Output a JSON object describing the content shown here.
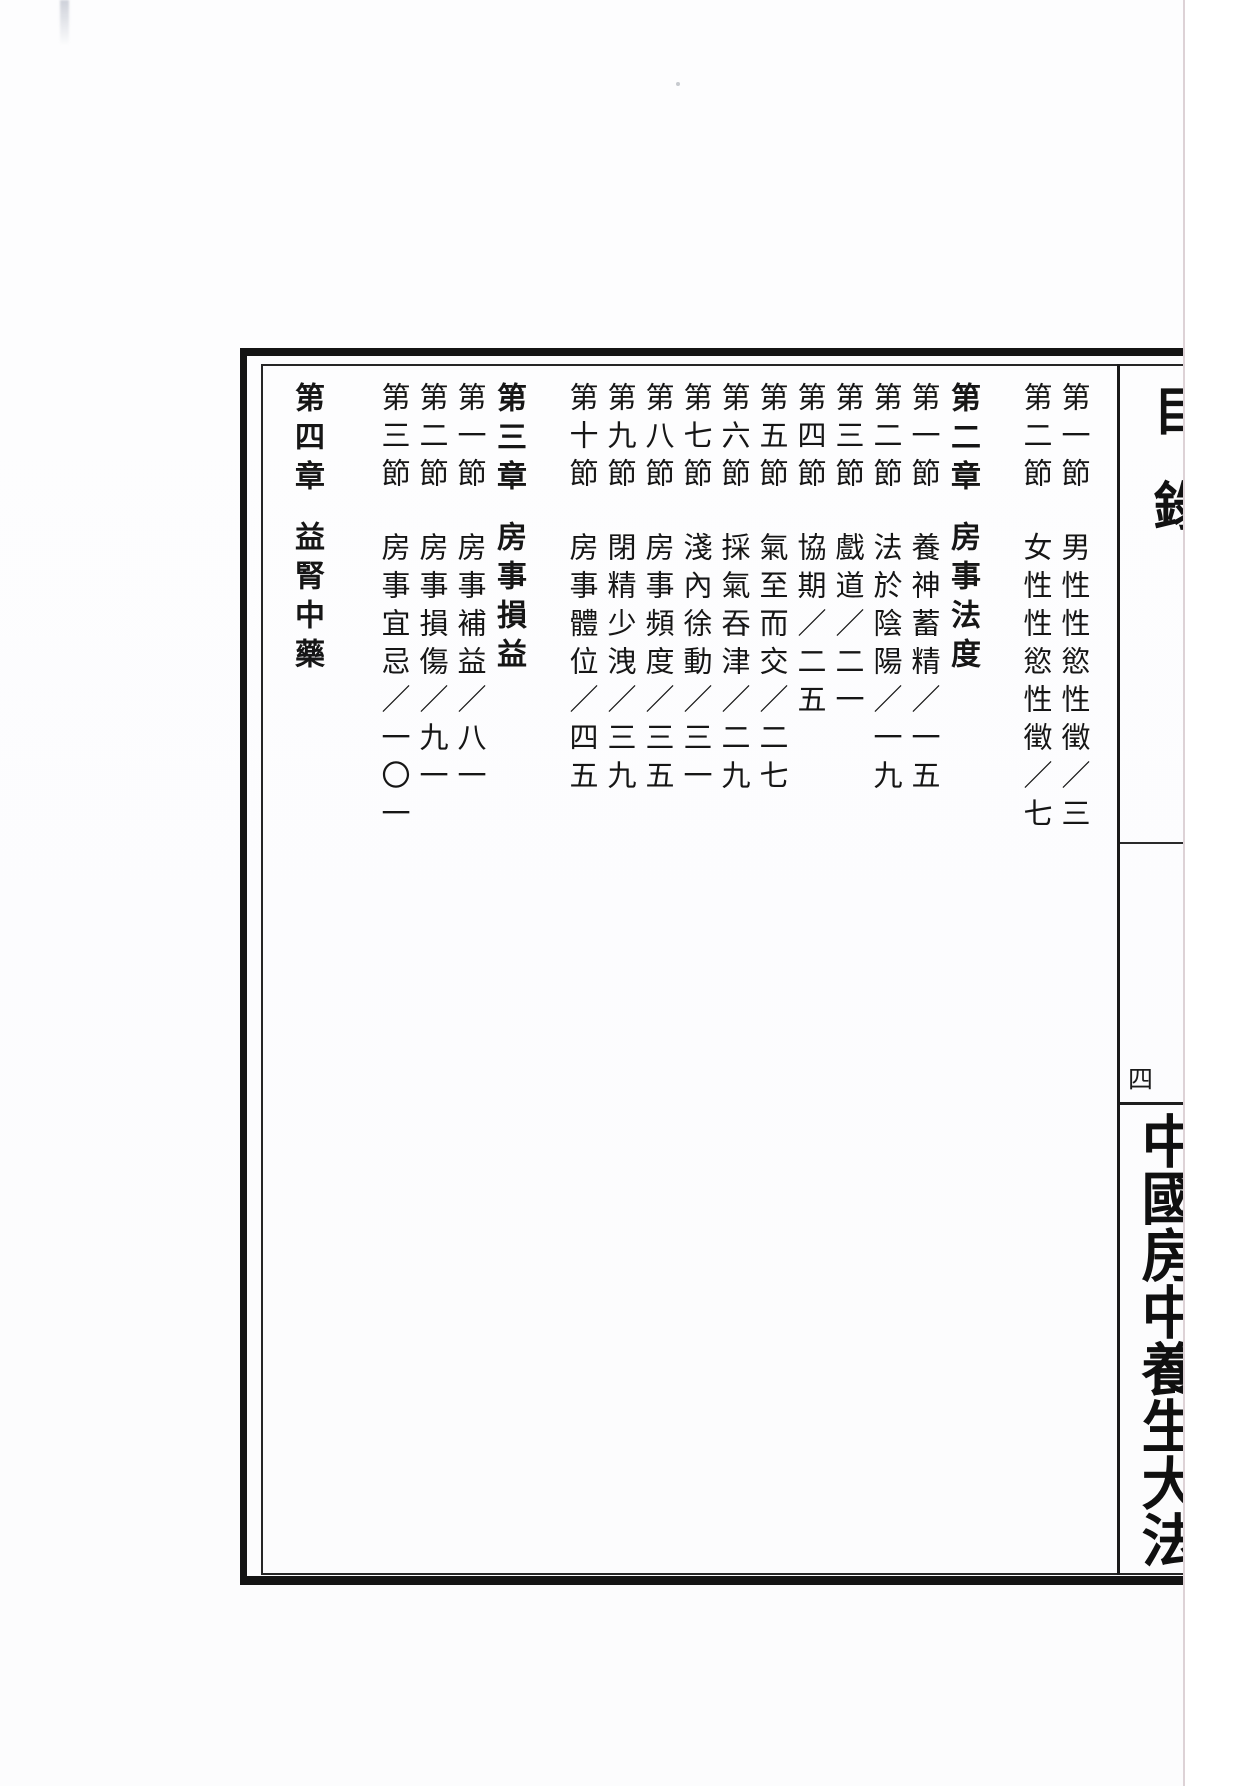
{
  "page": {
    "toc_title": "目錄",
    "folio": "四",
    "book_title": "中國房中養生大法"
  },
  "toc": {
    "entries": [
      {
        "label": "第一節",
        "text": "男性性慾性徵／三",
        "type": "section"
      },
      {
        "label": "第二節",
        "text": "女性性慾性徵／七",
        "type": "section"
      },
      {
        "label": "第二章",
        "text": "房事法度",
        "type": "chapter"
      },
      {
        "label": "第一節",
        "text": "養神蓄精／一五",
        "type": "section"
      },
      {
        "label": "第二節",
        "text": "法於陰陽／一九",
        "type": "section"
      },
      {
        "label": "第三節",
        "text": "戲道／二一",
        "type": "section"
      },
      {
        "label": "第四節",
        "text": "協期／二五",
        "type": "section"
      },
      {
        "label": "第五節",
        "text": "氣至而交／二七",
        "type": "section"
      },
      {
        "label": "第六節",
        "text": "採氣吞津／二九",
        "type": "section"
      },
      {
        "label": "第七節",
        "text": "淺內徐動／三一",
        "type": "section"
      },
      {
        "label": "第八節",
        "text": "房事頻度／三五",
        "type": "section"
      },
      {
        "label": "第九節",
        "text": "閉精少洩／三九",
        "type": "section"
      },
      {
        "label": "第十節",
        "text": "房事體位／四五",
        "type": "section"
      },
      {
        "label": "第三章",
        "text": "房事損益",
        "type": "chapter"
      },
      {
        "label": "第一節",
        "text": "房事補益／八一",
        "type": "section"
      },
      {
        "label": "第二節",
        "text": "房事損傷／九一",
        "type": "section"
      },
      {
        "label": "第三節",
        "text": "房事宜忌／一〇一",
        "type": "section"
      },
      {
        "label": "第四章",
        "text": "益腎中藥",
        "type": "chapter"
      }
    ]
  },
  "colors": {
    "ink": "#161616",
    "frame": "#141414",
    "scan_edge": "#ddd2d6",
    "paper": "#fdfdfe"
  }
}
